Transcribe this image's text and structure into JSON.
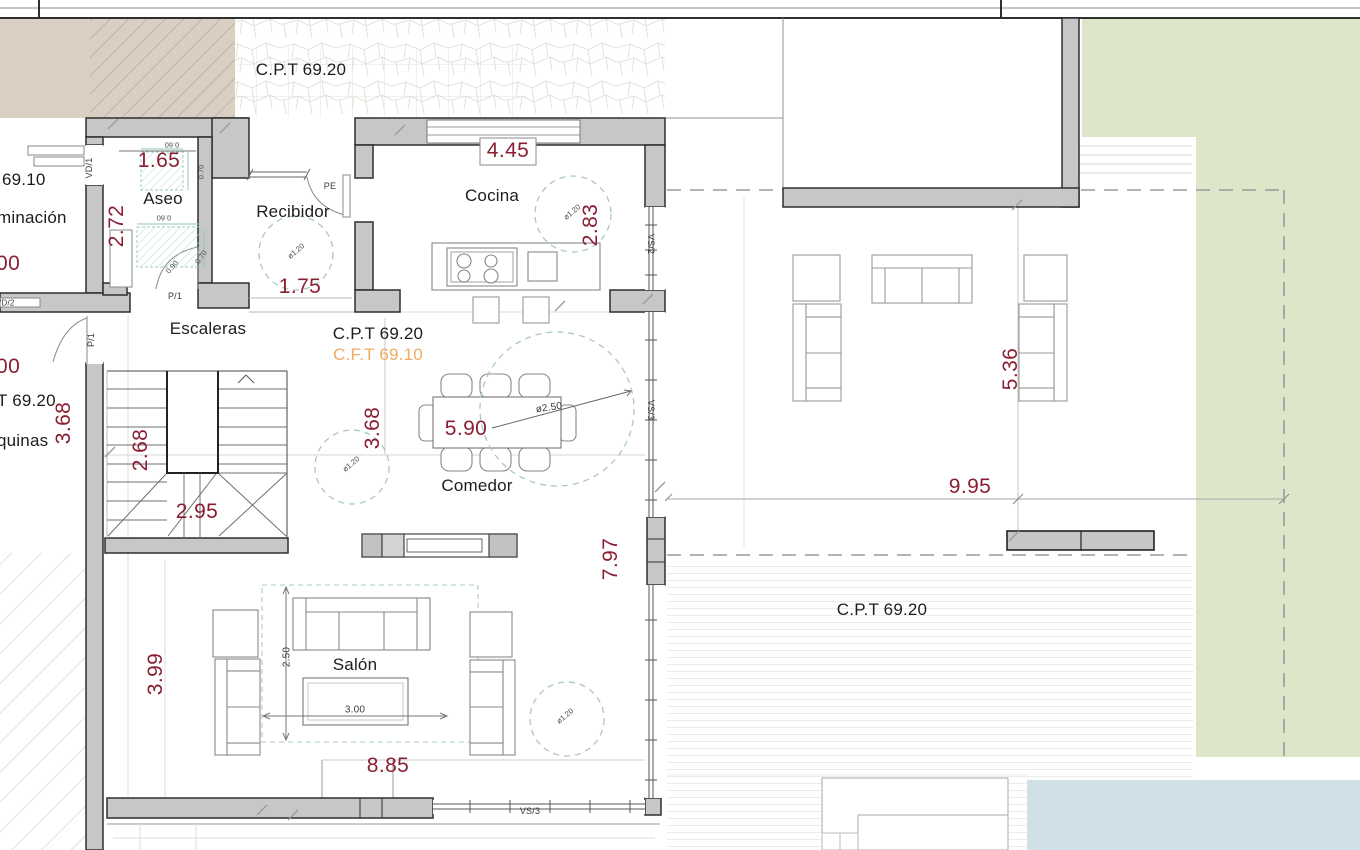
{
  "labels": {
    "cpt_top": "C.P.T 69.20",
    "cpt_mid": "C.P.T 69.20",
    "cft_mid": "C.F.T 69.10",
    "cpt_terrace": "C.P.T 69.20",
    "aseo": "Aseo",
    "recibidor": "Recibidor",
    "cocina": "Cocina",
    "escaleras": "Escaleras",
    "comedor": "Comedor",
    "salon": "Salón",
    "left_69_10": "69.10",
    "left_minacion": "minación",
    "left_t6920": "T 69.20",
    "left_quinas": "quinas",
    "pe": "PE",
    "p1_aseo": "P/1",
    "p1_left": "P/1",
    "vd1": "VD/1",
    "vd2": "VD/2",
    "vs2": "VS/2",
    "vs3_right": "VS/3",
    "vs3_bottom": "VS/3"
  },
  "dims": {
    "aseo_w": "1.65",
    "aseo_h": "2.72",
    "recibidor_w": "1.75",
    "cocina_w": "4.45",
    "cocina_h": "2.83",
    "left_368": "3.68",
    "left_00_a": "00",
    "left_00_b": "00",
    "stairs_268": "2.68",
    "stairs_295": "2.95",
    "comedor_368": "3.68",
    "table_590": "5.90",
    "right_797": "7.97",
    "salon_399": "3.99",
    "salon_885": "8.85",
    "terrace_536": "5.36",
    "terrace_995": "9.95",
    "rug_250": "2.50",
    "rug_300": "3.00",
    "dia_250": "ø2.50",
    "dia_recibidor": "ø1.20",
    "dia_cocina": "ø1.20",
    "dia_comedor": "ø1.20",
    "dia_salon": "ø1.20",
    "fix_060_a": "0.60",
    "fix_060_b": "0.60",
    "fix_070_a": "0.70",
    "fix_070_b": "0.70",
    "fix_090": "0.90"
  },
  "colors": {
    "wall": "#c7c7c7",
    "dim_text": "#8a1f33",
    "orange_text": "#efab5e",
    "lawn": "#dee6ca",
    "pool": "#cfe1e7",
    "beige": "#d9cfc3",
    "teal_dash": "#a9c8c2"
  }
}
